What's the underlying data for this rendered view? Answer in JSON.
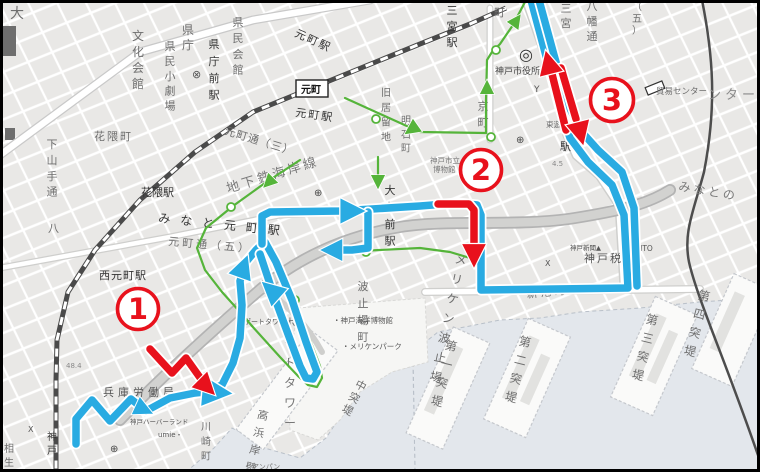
{
  "map": {
    "area_hint": "Kobe waterfront tourist map with numbered route checkpoints",
    "colors": {
      "route_blue": "#29abe2",
      "route_green": "#55b43a",
      "arrow_red": "#e8111c",
      "water": "#e3e7ec",
      "land": "#e9e8e6",
      "elevated_road": "#b3b3b3",
      "rail_dark": "#4a4a4a",
      "label_gray": "#6e6e6e",
      "frame": "#000000"
    },
    "markers": [
      {
        "n": "1",
        "x": 138,
        "y": 309,
        "r": 20.5
      },
      {
        "n": "2",
        "x": 481,
        "y": 170,
        "r": 20.5
      },
      {
        "n": "3",
        "x": 612,
        "y": 100,
        "r": 21.5
      }
    ],
    "red_arrows": {
      "width": 7.5,
      "paths": [
        [
          [
            150,
            349
          ],
          [
            172,
            373
          ],
          [
            186,
            358
          ],
          [
            201,
            379
          ]
        ],
        [
          [
            438,
            204
          ],
          [
            469,
            204
          ],
          [
            474,
            210
          ],
          [
            474,
            243
          ]
        ],
        [
          [
            566,
            130
          ],
          [
            552,
            74
          ]
        ],
        [
          [
            561,
            68
          ],
          [
            576,
            119
          ]
        ]
      ],
      "heads": [
        {
          "x": 206,
          "y": 386,
          "a": 135,
          "s": 1.4
        },
        {
          "x": 474,
          "y": 254,
          "a": 180,
          "s": 1.5
        },
        {
          "x": 549,
          "y": 64,
          "a": -14,
          "s": 1.5
        },
        {
          "x": 580,
          "y": 132,
          "a": 166,
          "s": 1.5
        }
      ]
    },
    "blue_route": {
      "width": 7.5,
      "paths": [
        [
          [
            76,
            444
          ],
          [
            76,
            419
          ],
          [
            92,
            400
          ],
          [
            110,
            421
          ],
          [
            131,
            399
          ],
          [
            146,
            411
          ],
          [
            170,
            398
          ],
          [
            195,
            393
          ],
          [
            205,
            392
          ],
          [
            222,
            385
          ],
          [
            233,
            363
          ],
          [
            240,
            338
          ],
          [
            242,
            305
          ],
          [
            240,
            281
          ],
          [
            246,
            262
          ],
          [
            256,
            250
          ],
          [
            262,
            244
          ]
        ],
        [
          [
            265,
            242
          ],
          [
            276,
            262
          ],
          [
            292,
            300
          ],
          [
            306,
            342
          ],
          [
            314,
            364
          ],
          [
            317,
            372
          ],
          [
            313,
            379
          ],
          [
            306,
            378
          ],
          [
            300,
            366
          ],
          [
            288,
            334
          ],
          [
            274,
            296
          ],
          [
            266,
            272
          ],
          [
            260,
            254
          ]
        ],
        [
          [
            262,
            244
          ],
          [
            262,
            216
          ],
          [
            270,
            212
          ],
          [
            340,
            211
          ],
          [
            420,
            206
          ],
          [
            458,
            203
          ]
        ],
        [
          [
            368,
            212
          ],
          [
            368,
            248
          ],
          [
            352,
            250
          ],
          [
            338,
            250
          ]
        ],
        [
          [
            458,
            203
          ],
          [
            477,
            205
          ],
          [
            481,
            215
          ],
          [
            481,
            290
          ],
          [
            628,
            288
          ],
          [
            624,
            215
          ],
          [
            612,
            185
          ],
          [
            588,
            162
          ],
          [
            570,
            138
          ],
          [
            560,
            108
          ],
          [
            546,
            56
          ],
          [
            531,
            0
          ]
        ],
        [
          [
            539,
            0
          ],
          [
            554,
            55
          ],
          [
            568,
            104
          ],
          [
            580,
            130
          ],
          [
            598,
            150
          ],
          [
            622,
            172
          ],
          [
            634,
            208
          ],
          [
            637,
            286
          ]
        ]
      ],
      "heads": [
        {
          "x": 143,
          "y": 409,
          "a": 115,
          "s": 1.2
        },
        {
          "x": 215,
          "y": 392,
          "a": 95,
          "s": 1.9
        },
        {
          "x": 243,
          "y": 268,
          "a": 20,
          "s": 1.5
        },
        {
          "x": 272,
          "y": 291,
          "a": -48,
          "s": 1.5
        },
        {
          "x": 351,
          "y": 211,
          "a": 90,
          "s": 1.6
        },
        {
          "x": 333,
          "y": 250,
          "a": -90,
          "s": 1.4
        }
      ]
    },
    "green_route": {
      "width": 2.2,
      "paths": [
        [
          [
            345,
            98
          ],
          [
            420,
            132
          ],
          [
            486,
            133
          ],
          [
            486,
            100
          ]
        ],
        [
          [
            486,
            100
          ],
          [
            487,
            60
          ],
          [
            492,
            52
          ],
          [
            500,
            44
          ],
          [
            513,
            25
          ],
          [
            526,
            0
          ]
        ],
        [
          [
            300,
            160
          ],
          [
            265,
            183
          ],
          [
            233,
            206
          ],
          [
            206,
            228
          ],
          [
            197,
            248
          ],
          [
            205,
            270
          ],
          [
            222,
            292
          ],
          [
            240,
            312
          ],
          [
            252,
            326
          ]
        ],
        [
          [
            252,
            326
          ],
          [
            280,
            357
          ],
          [
            298,
            376
          ],
          [
            308,
            385
          ],
          [
            317,
            387
          ],
          [
            322,
            378
          ],
          [
            320,
            366
          ],
          [
            310,
            340
          ],
          [
            294,
            300
          ],
          [
            282,
            272
          ],
          [
            272,
            255
          ],
          [
            265,
            246
          ]
        ],
        [
          [
            340,
            252
          ],
          [
            380,
            250
          ],
          [
            420,
            248
          ],
          [
            450,
            252
          ],
          [
            470,
            258
          ]
        ],
        [
          [
            378,
            157
          ],
          [
            378,
            186
          ]
        ]
      ],
      "heads": [
        {
          "x": 412,
          "y": 129,
          "a": 235,
          "s": 1.0
        },
        {
          "x": 487,
          "y": 88,
          "a": 0,
          "s": 0.9
        },
        {
          "x": 516,
          "y": 21,
          "a": 35,
          "s": 0.9
        },
        {
          "x": 269,
          "y": 182,
          "a": 225,
          "s": 0.9
        },
        {
          "x": 378,
          "y": 181,
          "a": 180,
          "s": 0.9
        }
      ],
      "nodes": [
        [
          496,
          50
        ],
        [
          491,
          137
        ],
        [
          376,
          119
        ],
        [
          231,
          207
        ],
        [
          366,
          252
        ],
        [
          295,
          300
        ]
      ]
    },
    "labels": [
      {
        "t": "大",
        "x": 10,
        "y": 18,
        "s": 14
      },
      {
        "t": "文化会館",
        "x": 138,
        "y": 40,
        "s": 12,
        "v": 1,
        "sp": 3
      },
      {
        "t": "県民小劇場",
        "x": 170,
        "y": 50,
        "s": 11,
        "v": 1,
        "sp": 3
      },
      {
        "t": "県庁",
        "x": 188,
        "y": 34,
        "s": 12,
        "v": 1,
        "sp": 2
      },
      {
        "t": "⊗",
        "x": 192,
        "y": 78,
        "s": 11,
        "c": "#555"
      },
      {
        "t": "県庁前駅",
        "x": 214,
        "y": 48,
        "s": 11,
        "v": 1,
        "sp": 5,
        "c": "#333"
      },
      {
        "t": "県民会館",
        "x": 238,
        "y": 26,
        "s": 11,
        "v": 1,
        "sp": 4
      },
      {
        "t": "花隈町",
        "x": 94,
        "y": 140,
        "s": 11,
        "ls": 2
      },
      {
        "t": "下山手通",
        "x": 52,
        "y": 148,
        "s": 11,
        "v": 1,
        "sp": 4
      },
      {
        "t": "八",
        "x": 48,
        "y": 232,
        "s": 11
      },
      {
        "t": "花隈駅",
        "x": 141,
        "y": 196,
        "s": 11,
        "c": "#333"
      },
      {
        "t": "元町駅",
        "x": 294,
        "y": 36,
        "s": 11,
        "r": 24,
        "c": "#333",
        "ls": 2
      },
      {
        "t": "元町",
        "x": 301,
        "y": 93,
        "s": 10,
        "box": 1,
        "c": "#111"
      },
      {
        "t": "元町駅",
        "x": 295,
        "y": 116,
        "s": 11,
        "r": 8,
        "c": "#333",
        "ls": 2
      },
      {
        "t": "元町通（三）",
        "x": 224,
        "y": 134,
        "s": 11,
        "r": 17,
        "ls": 1
      },
      {
        "t": "地下鉄海岸線",
        "x": 228,
        "y": 193,
        "s": 13,
        "r": -17,
        "c": "#7a7a7a",
        "ls": 3
      },
      {
        "t": "みなと元町駅",
        "x": 158,
        "y": 222,
        "s": 12,
        "r": 6,
        "c": "#333",
        "ls": 10
      },
      {
        "t": "元町通（五）",
        "x": 168,
        "y": 245,
        "s": 11,
        "r": 5,
        "ls": 3
      },
      {
        "t": "西元町駅",
        "x": 99,
        "y": 279,
        "s": 11,
        "c": "#333",
        "ls": 1
      },
      {
        "t": "三宮駅",
        "x": 452,
        "y": 14,
        "s": 11,
        "v": 1,
        "sp": 4,
        "c": "#333"
      },
      {
        "t": "町",
        "x": 494,
        "y": 16,
        "s": 11
      },
      {
        "t": "三宮",
        "x": 566,
        "y": 12,
        "s": 11,
        "v": 1,
        "sp": 3
      },
      {
        "t": "八幡通",
        "x": 592,
        "y": 10,
        "s": 11,
        "v": 1,
        "sp": 3
      },
      {
        "t": "（五）",
        "x": 637,
        "y": 10,
        "s": 10,
        "v": 1,
        "sp": 1
      },
      {
        "t": "◎",
        "x": 519,
        "y": 60,
        "s": 16,
        "c": "#333"
      },
      {
        "t": "神戸市役所",
        "x": 495,
        "y": 74,
        "s": 9,
        "c": "#444"
      },
      {
        "t": "Y",
        "x": 534,
        "y": 92,
        "s": 9,
        "c": "#555"
      },
      {
        "t": "貿易センター",
        "x": 656,
        "y": 94,
        "s": 8.5
      },
      {
        "t": "ンター",
        "x": 708,
        "y": 99,
        "s": 13,
        "c": "#8a8a8a",
        "ls": 4
      },
      {
        "t": "旧居留地",
        "x": 386,
        "y": 96,
        "s": 10,
        "v": 1,
        "sp": 4
      },
      {
        "t": "明石町",
        "x": 406,
        "y": 124,
        "s": 10,
        "v": 1,
        "sp": 3
      },
      {
        "t": "京町",
        "x": 483,
        "y": 110,
        "s": 11,
        "v": 1,
        "sp": 4
      },
      {
        "t": "神戸市立",
        "x": 430,
        "y": 163,
        "s": 7.5,
        "c": "#777"
      },
      {
        "t": "博物館",
        "x": 433,
        "y": 172,
        "s": 7.5,
        "c": "#777"
      },
      {
        "t": "東遊園",
        "x": 546,
        "y": 127,
        "s": 7.5
      },
      {
        "t": "4.5",
        "x": 552,
        "y": 166,
        "s": 7,
        "c": "#888"
      },
      {
        "t": "駅",
        "x": 560,
        "y": 150,
        "s": 11,
        "c": "#333"
      },
      {
        "t": "大丸前駅",
        "x": 390,
        "y": 194,
        "s": 11,
        "v": 1,
        "sp": 5,
        "c": "#333"
      },
      {
        "t": "みなとの",
        "x": 678,
        "y": 190,
        "s": 12,
        "r": 10,
        "c": "#7a7a7a",
        "ls": 3
      },
      {
        "t": "神戸新聞▲",
        "x": 570,
        "y": 250,
        "s": 6.5,
        "c": "#555"
      },
      {
        "t": "KIITO",
        "x": 633,
        "y": 251,
        "s": 7.5,
        "c": "#555"
      },
      {
        "t": "神戸税関",
        "x": 584,
        "y": 262,
        "s": 11,
        "c": "#555",
        "ls": 2
      },
      {
        "t": "X",
        "x": 545,
        "y": 266,
        "s": 8,
        "c": "#555"
      },
      {
        "t": "新港町",
        "x": 527,
        "y": 298,
        "s": 11,
        "r": -6,
        "ls": 3
      },
      {
        "t": "第一突堤",
        "x": 450,
        "y": 350,
        "s": 12,
        "v": 1,
        "sp": 6,
        "r": 14
      },
      {
        "t": "第二突堤",
        "x": 524,
        "y": 346,
        "s": 12,
        "v": 1,
        "sp": 6,
        "r": 14
      },
      {
        "t": "第三突堤",
        "x": 651,
        "y": 324,
        "s": 12,
        "v": 1,
        "sp": 6,
        "r": 14
      },
      {
        "t": "第四突堤",
        "x": 703,
        "y": 300,
        "s": 12,
        "v": 1,
        "sp": 6,
        "r": 14
      },
      {
        "t": "メリケン波止場",
        "x": 460,
        "y": 264,
        "s": 12,
        "v": 1,
        "sp": 7,
        "r": 12
      },
      {
        "t": "波止場町",
        "x": 363,
        "y": 290,
        "s": 11,
        "v": 1,
        "sp": 5
      },
      {
        "t": "中突堤",
        "x": 359,
        "y": 389,
        "s": 11,
        "v": 1,
        "sp": 2,
        "r": 28
      },
      {
        "t": "高浜岸壁",
        "x": 262,
        "y": 419,
        "s": 11,
        "v": 1,
        "sp": 6,
        "r": 13
      },
      {
        "t": "ポートタワー",
        "x": 290,
        "y": 327,
        "s": 12,
        "v": 1,
        "sp": 7,
        "c": "#777"
      },
      {
        "t": "ポートタワー・",
        "x": 244,
        "y": 324,
        "s": 7,
        "c": "#555"
      },
      {
        "t": "・神戸海洋博物館",
        "x": 333,
        "y": 323,
        "s": 7.5,
        "c": "#555"
      },
      {
        "t": "・メリケンパーク",
        "x": 342,
        "y": 349,
        "s": 7.5,
        "c": "#555"
      },
      {
        "t": "兵庫労働局",
        "x": 103,
        "y": 396,
        "s": 11,
        "c": "#555",
        "ls": 4
      },
      {
        "t": "48.4",
        "x": 66,
        "y": 368,
        "s": 7,
        "c": "#888"
      },
      {
        "t": "神戸ハーバーランド",
        "x": 130,
        "y": 424,
        "s": 6.5,
        "c": "#555"
      },
      {
        "t": "umie・",
        "x": 158,
        "y": 437,
        "s": 7,
        "c": "#555"
      },
      {
        "t": "川崎町",
        "x": 206,
        "y": 430,
        "s": 10,
        "v": 1,
        "sp": 4
      },
      {
        "t": "神戸",
        "x": 52,
        "y": 440,
        "s": 10,
        "v": 1,
        "sp": 3,
        "c": "#333"
      },
      {
        "t": "相生町",
        "x": 9,
        "y": 452,
        "s": 10,
        "v": 1,
        "sp": 3
      },
      {
        "t": "アンパン",
        "x": 252,
        "y": 469,
        "s": 7,
        "c": "#777"
      },
      {
        "t": "X",
        "x": 28,
        "y": 432,
        "s": 8,
        "c": "#555"
      },
      {
        "t": "⊕",
        "x": 314,
        "y": 196,
        "s": 10,
        "c": "#444"
      },
      {
        "t": "⊕",
        "x": 110,
        "y": 452,
        "s": 10,
        "c": "#444"
      },
      {
        "t": "⊕",
        "x": 516,
        "y": 143,
        "s": 10,
        "c": "#444"
      }
    ]
  }
}
